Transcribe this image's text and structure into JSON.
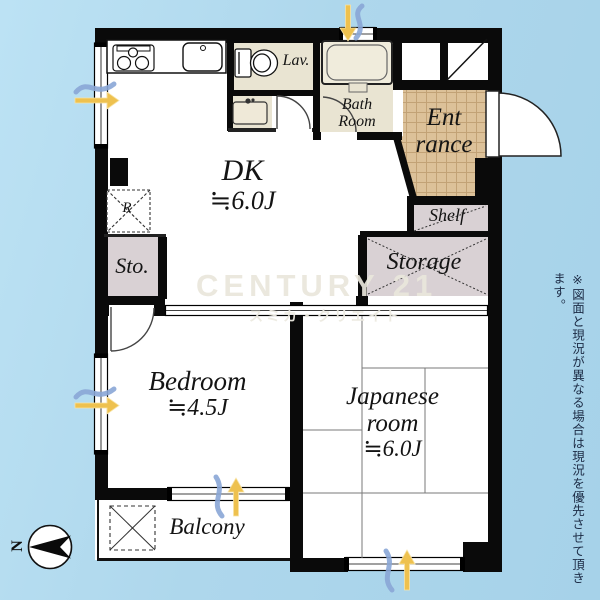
{
  "watermark": {
    "brand": "CENTURY 21",
    "subtitle": "スミカ・クリエイト"
  },
  "disclaimer": "※図面と現況が異なる場合は現況を優先させて頂きます。",
  "compass": {
    "north": "N"
  },
  "rooms": {
    "dk": {
      "name": "DK",
      "size": "≒6.0J"
    },
    "bedroom": {
      "name": "Bedroom",
      "size": "≒4.5J"
    },
    "japanese_room": {
      "line1": "Japanese",
      "line2": "room",
      "size": "≒6.0J"
    },
    "bath": {
      "line1": "Bath",
      "line2": "Room"
    },
    "lav": {
      "name": "Lav."
    },
    "entrance": {
      "line1": "Ent",
      "line2": "rance"
    },
    "shelf": {
      "name": "Shelf"
    },
    "storage": {
      "name": "Storage"
    },
    "sto": {
      "name": "Sto."
    },
    "balcony": {
      "name": "Balcony"
    },
    "refrigerator": {
      "name": "R"
    }
  },
  "colors": {
    "wall": "#0a0a0a",
    "room_white": "#ffffff",
    "wet_area_beige": "#e9e4d2",
    "entrance_tile": "#dcc199",
    "closet_mauve": "#d9d1d4",
    "arrow_yellow": "#eec14f",
    "arrow_blue": "#8aa6d6",
    "background_blue": "#aed7ec"
  }
}
